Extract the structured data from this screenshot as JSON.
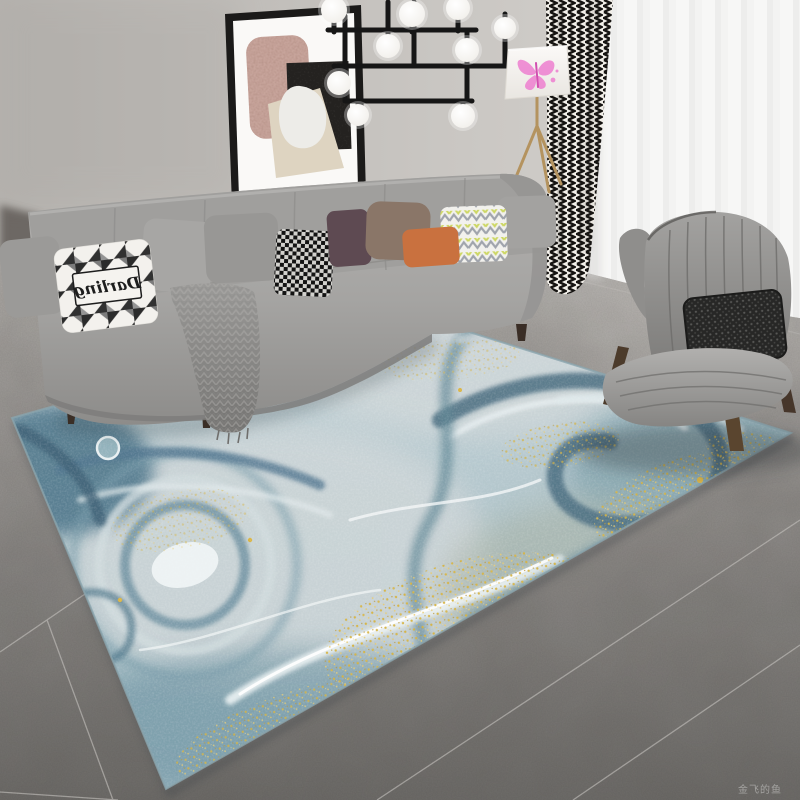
{
  "meta": {
    "description": "Product photo: abstract blue-grey liquid-marble area rug with gold glitter in a modern living room"
  },
  "texts": {
    "pillow_script": "Darling",
    "watermark": "金飞的鱼"
  },
  "colors": {
    "wall": "#c6c3bf",
    "floor_light": "#b2afab",
    "floor_dark": "#747270",
    "sofa_grey": "#a6a5a3",
    "chair_grey": "#8b8a88",
    "rug_base": "#aec3c9",
    "rug_blue": "#5d8396",
    "rug_dark_teal": "#3f6579",
    "rug_white": "#edf2f3",
    "glitter_gold": "#d4af37",
    "accent_orange": "#c9713f",
    "butterfly_pink": "#ee7fd0",
    "curtain_ink": "#1a1a1a",
    "lamp_brass": "#b4935f"
  }
}
